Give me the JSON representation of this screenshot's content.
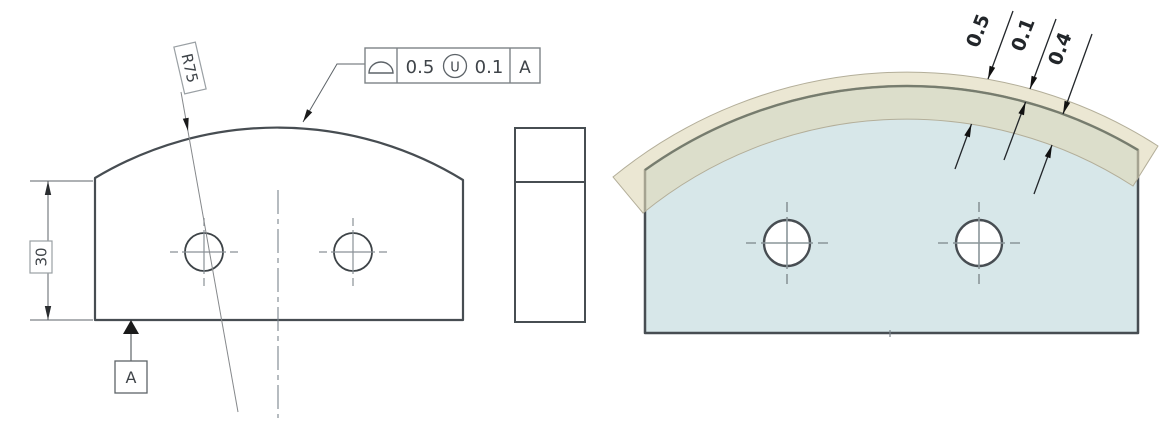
{
  "drawing": {
    "front_view": {
      "radius_label": "R75",
      "height_label": "30",
      "datum_label": "A",
      "fcf": {
        "symbol": "profile-of-a-surface",
        "tolerance": "0.5",
        "modifier": "U",
        "outer_zone": "0.1",
        "datum": "A"
      }
    },
    "iso_view": {
      "total_zone": "0.5",
      "outside_zone": "0.1",
      "inside_zone": "0.4"
    },
    "colors": {
      "part_fill": "#d7e7e9",
      "zone_fill": "#ded8b8",
      "outline": "#474d52",
      "line": "#5d6368"
    }
  }
}
